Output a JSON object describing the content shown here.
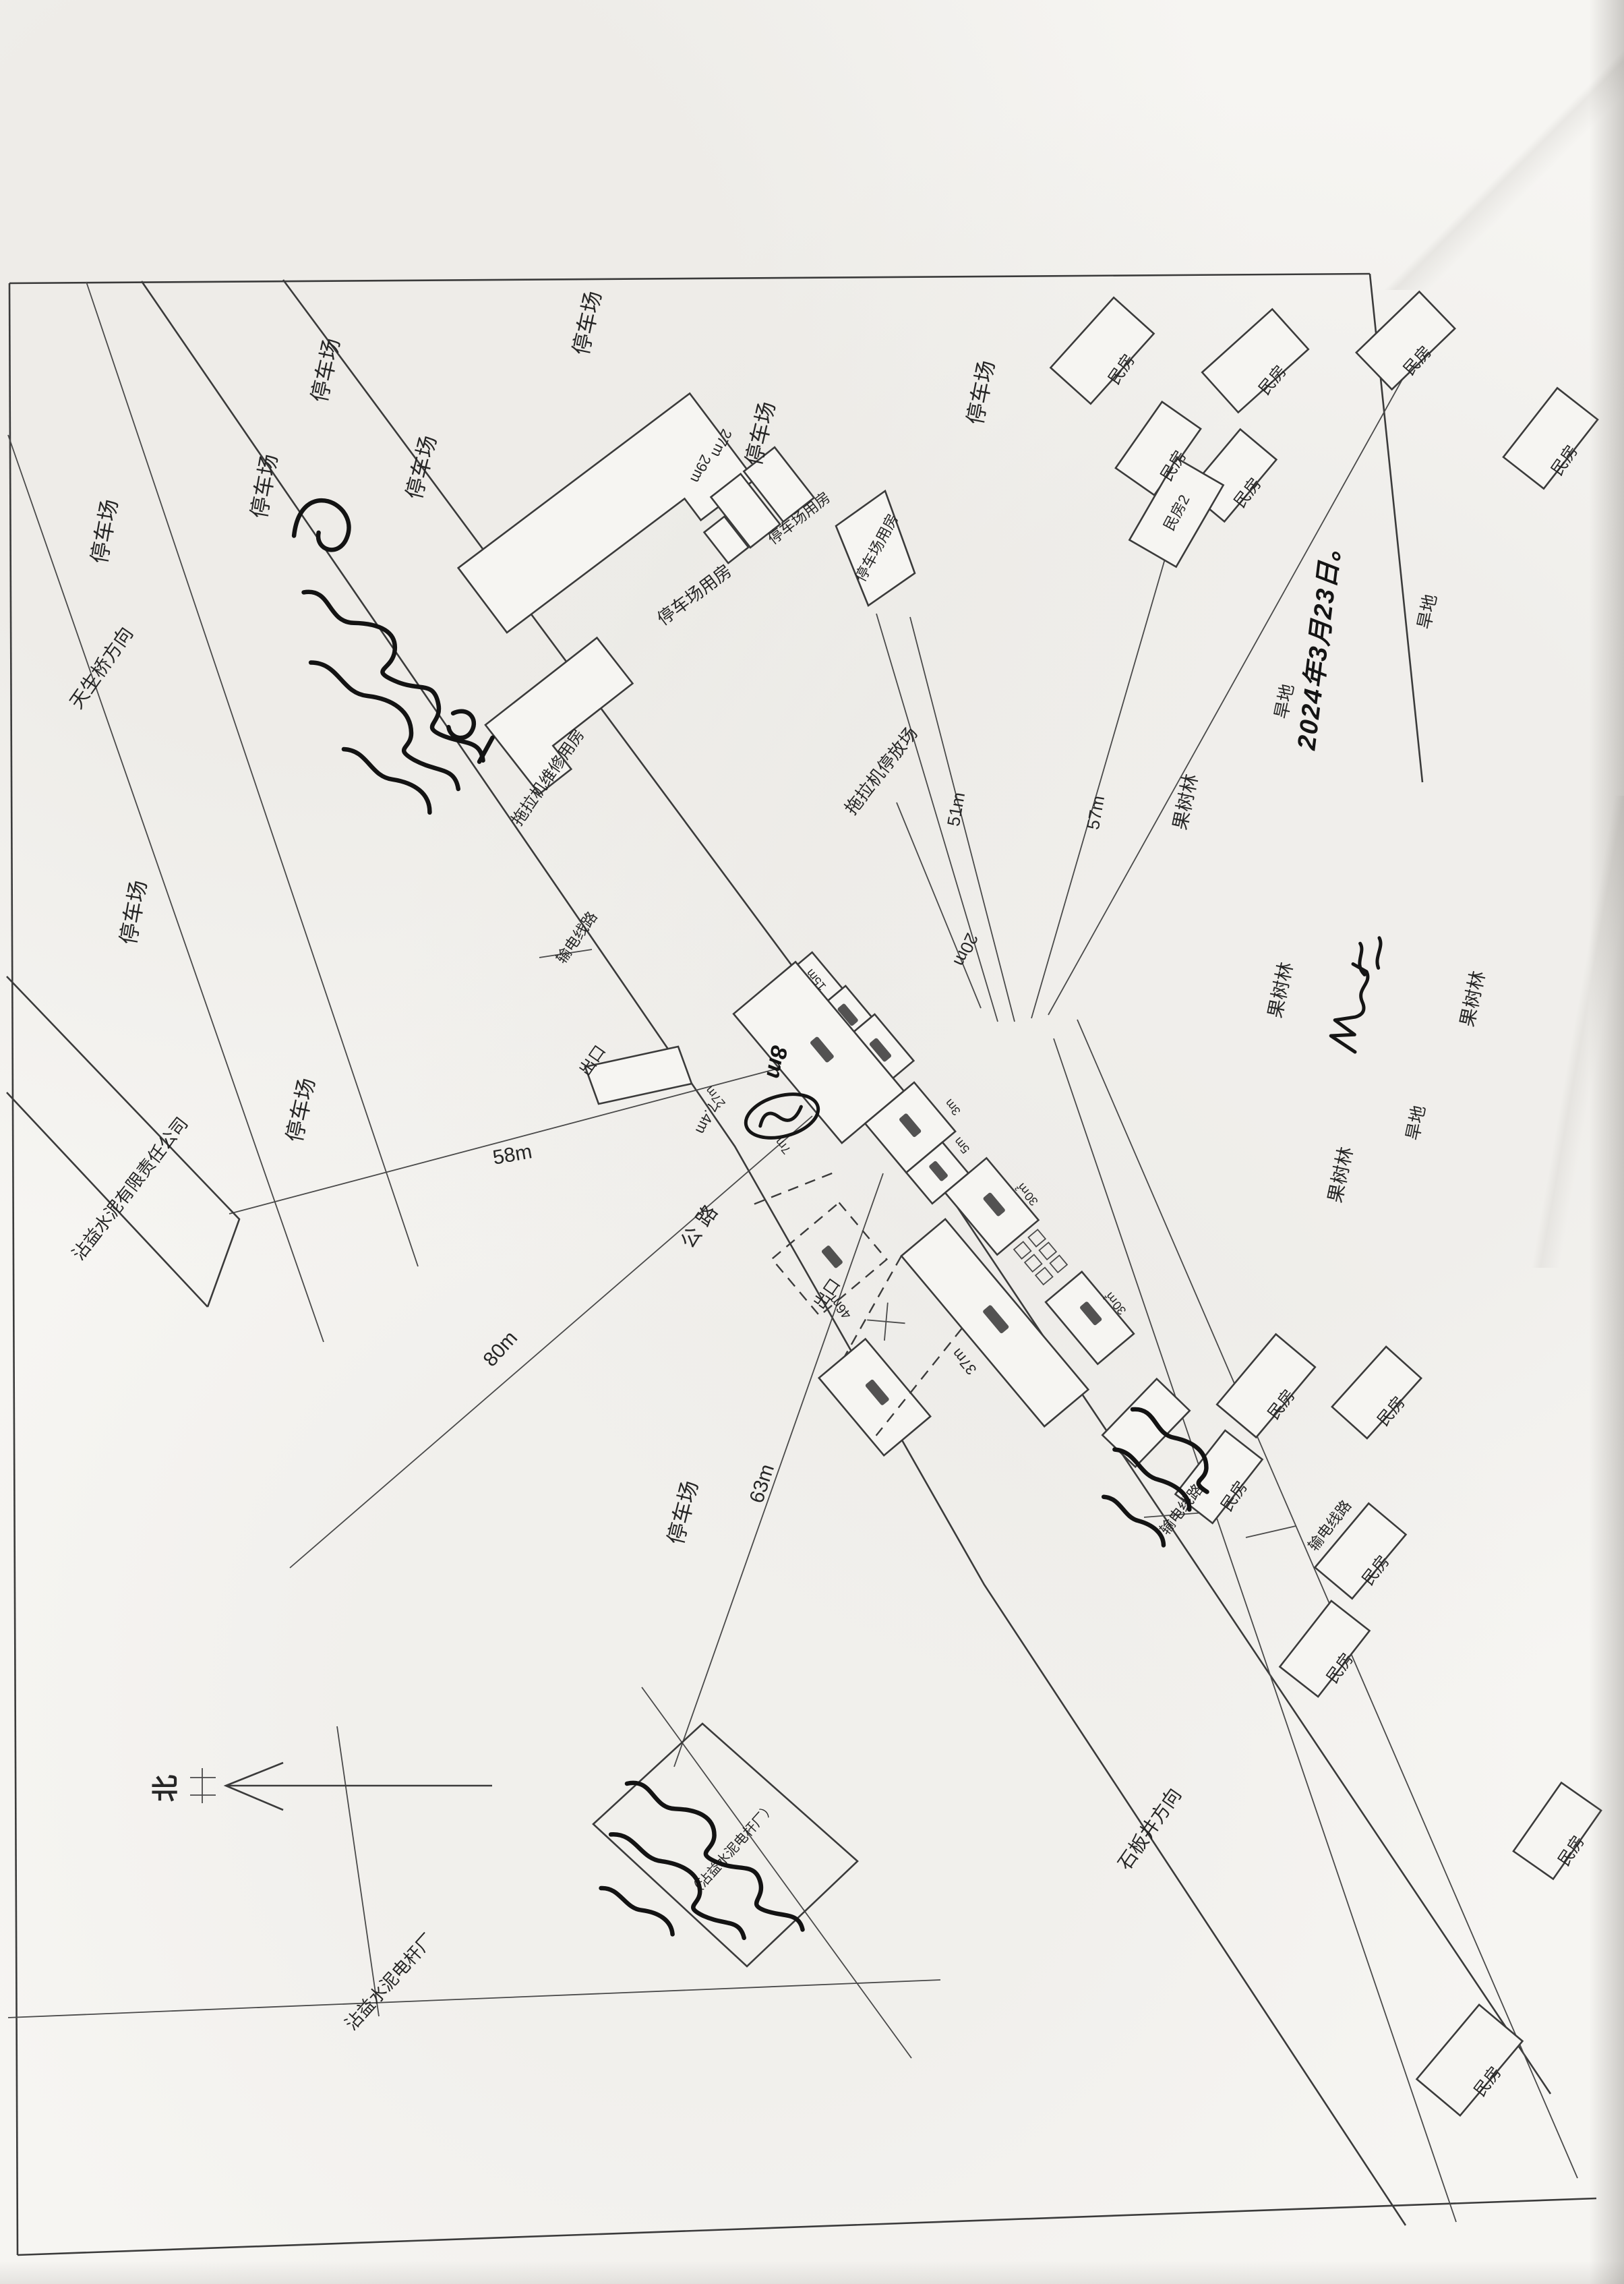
{
  "palette": {
    "paper": "#f6f5f2",
    "line_ink": "#3b3b3b",
    "text_ink": "#262626",
    "pen_ink": "#151515"
  },
  "labels": {
    "parking": "停车场",
    "parking_building": "停车场用房",
    "tractor_parking": "拖拉机停放场",
    "tractor_repair": "拖拉机维修用房",
    "house": "民房",
    "house2": "民房2",
    "orchard": "果树林",
    "dry_land": "旱地",
    "road": "公路",
    "exit": "出口",
    "dir_tianshengqiao": "天生桥方向",
    "dir_shibanjing": "石板井方向",
    "cement_company": "沾益水泥有限责任公司",
    "cement_pole_factory": "沾益水泥电杆厂",
    "cement_pole_factory_paren": "（沾益水泥电杆厂）",
    "power_line": "输电线路",
    "north": "北"
  },
  "dims": {
    "m58": "58m",
    "m80": "80m",
    "m63": "63m",
    "m57": "57m",
    "m51": "51m",
    "m46": "46m",
    "m37": "37m",
    "m30": "30㎡",
    "m29": "29m",
    "m27": "27m",
    "m20": "20m",
    "m15": "15m",
    "m8": "8m",
    "m7": "7m",
    "m7_4": "7.4m",
    "m5": "5m",
    "m3": "3m"
  },
  "handwriting": {
    "date": "2024年3月23日。",
    "note_upper": "（手写批注，字迹潦草难以辨认）",
    "note_lower": "（手写批注，字迹潦草难以辨认）",
    "note_house": "（手写划记，字迹潦草）",
    "signature": "（手写签名）",
    "circle_mark": "（圈划记号）"
  }
}
